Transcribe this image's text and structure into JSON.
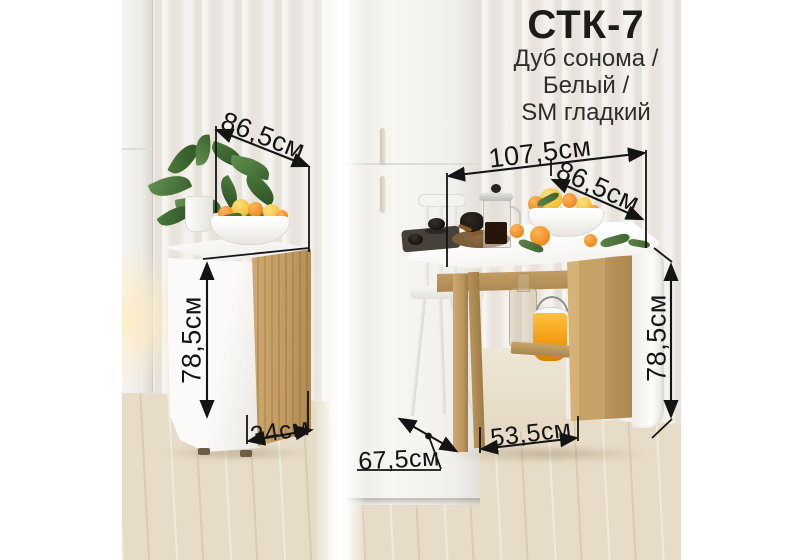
{
  "title": {
    "model": "СТК-7",
    "finish_lines": [
      "Дуб сонома /",
      "Белый /",
      "SM гладкий"
    ]
  },
  "dimensions": {
    "folded": {
      "width": "86,5см",
      "height": "78,5см",
      "depth": "34см"
    },
    "unfolded": {
      "length": "107,5см",
      "width": "86,5см",
      "height": "78,5см",
      "base": "53,5см",
      "depth": "67,5см"
    }
  },
  "colors": {
    "oak": "#c8a368",
    "furniture_white": "#f7f6f3",
    "wallpaper": "#ece8e1",
    "floor": "#e7dcc7",
    "dimension_line": "#141414",
    "bucket_yellow": "#f2a01d",
    "orange": "#ee9430",
    "lemon": "#f1c43c",
    "leaf_green": "#4e7a3e"
  }
}
